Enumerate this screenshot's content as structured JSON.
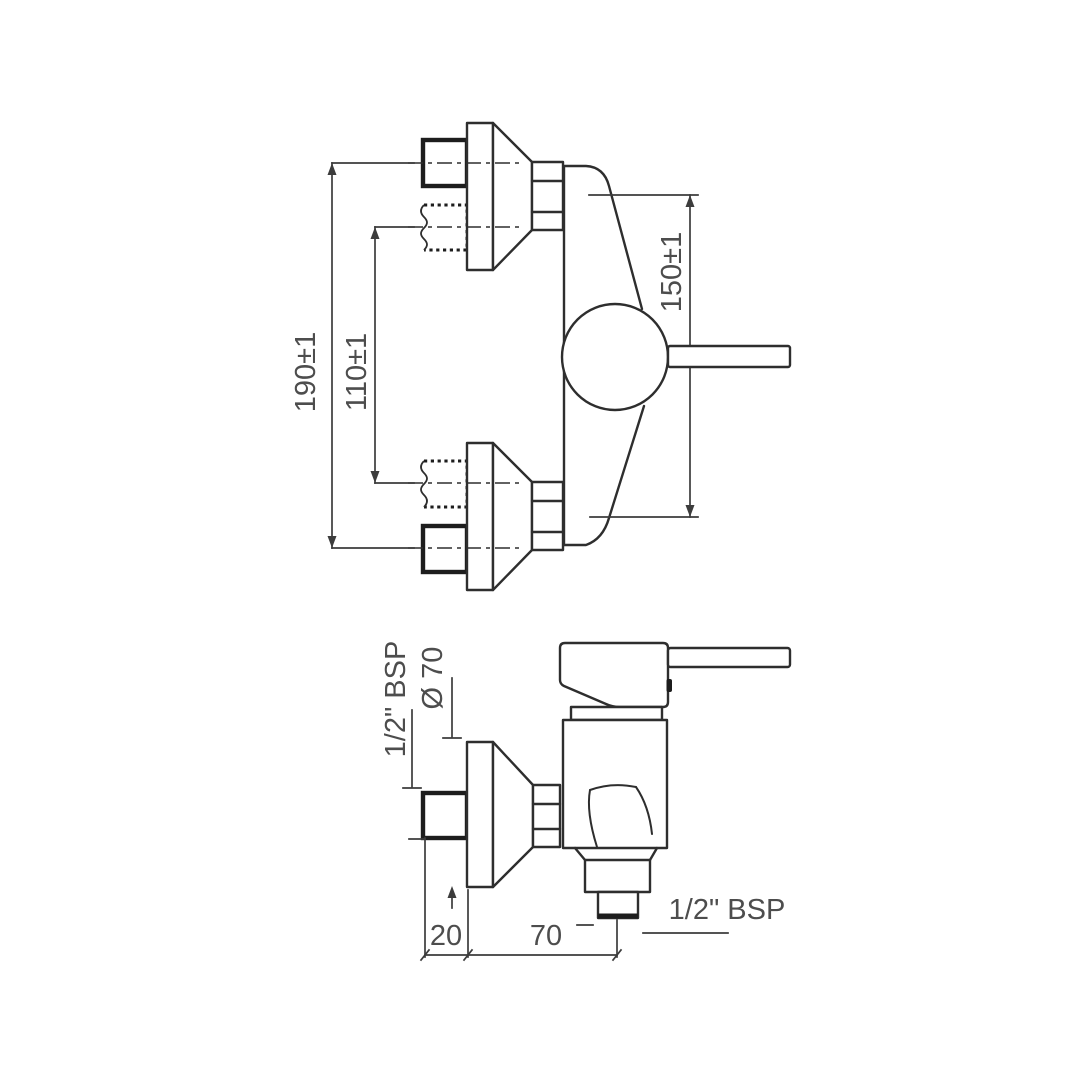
{
  "page": {
    "background": "#ffffff"
  },
  "drawing": {
    "type": "technical-dimension-drawing",
    "subject": "wall-mounted single-lever shower mixer",
    "line_color": "#2e2e2e",
    "dim_text_color": "#4d4d4d",
    "front_view": {
      "dim_overall_span": "190±1",
      "dim_inner_span": "110±1",
      "dim_connection_span": "150±1"
    },
    "side_view": {
      "inlet_thread": "1/2\" BSP",
      "flange_diameter": "Ø 70",
      "wall_offset": "20",
      "outlet_offset": "70",
      "outlet_thread": "1/2\" BSP"
    }
  }
}
